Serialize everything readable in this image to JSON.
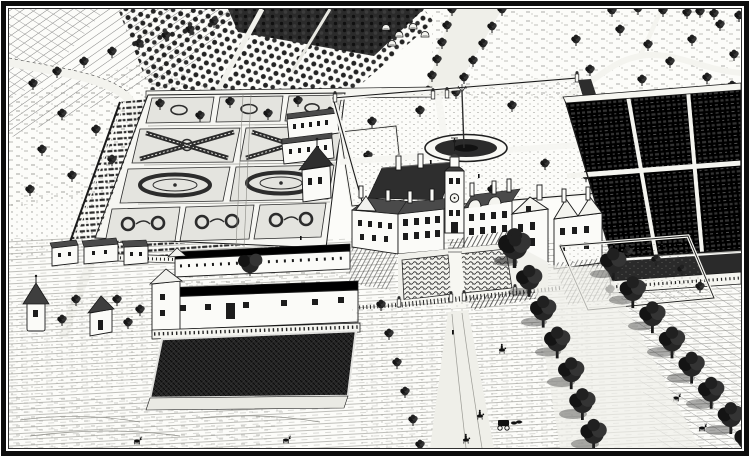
{
  "meta": {
    "title": "Bird's-eye view engraving of an English country estate with formal gardens",
    "medium": "monochrome copperplate engraving",
    "orientation": "oblique aerial view from the south-east"
  },
  "palette": {
    "paper": "#fcfcf9",
    "ink": "#1a1a1a",
    "mid_gray": "#555555",
    "light_gray": "#aaaaaa",
    "pond_water": "#262626"
  },
  "scene": {
    "regions": [
      {
        "name": "frame-border",
        "label": "heavy black rectangular frame"
      },
      {
        "name": "plowed-fields",
        "label": "ploughed strip fields, top left"
      },
      {
        "name": "hedgerow-trees",
        "label": "hedgerow trees along a winding lane"
      },
      {
        "name": "orchard",
        "label": "orchard planted in dense rows"
      },
      {
        "name": "north-avenue",
        "label": "tree-lined avenue receding north"
      },
      {
        "name": "haystacks",
        "label": "haystacks in a meadow"
      },
      {
        "name": "parkland",
        "label": "open parkland with scattered trees and winding path"
      },
      {
        "name": "parterre-garden",
        "label": "great parterre with saltire, oval and scroll beds"
      },
      {
        "name": "espalier-walls",
        "label": "espaliered fruit borders and garden walls"
      },
      {
        "name": "orangery-range",
        "label": "garden buildings along the terrace"
      },
      {
        "name": "garden-pavilion",
        "label": "pavilion with pyramidal roof"
      },
      {
        "name": "fountain-garden",
        "label": "walled lawn garden with oval basin and tall fountain jet"
      },
      {
        "name": "kitchen-garden",
        "label": "walled kitchen garden in bedded rows"
      },
      {
        "name": "manor-house",
        "label": "gabled manor house with clock tower and cupola"
      },
      {
        "name": "forecourt",
        "label": "forecourt parterre with balustrade and gate piers"
      },
      {
        "name": "bowling-green",
        "label": "walled green court with young trees"
      },
      {
        "name": "service-courtyard",
        "label": "barn and stable courtyard with great tree"
      },
      {
        "name": "cottages",
        "label": "row of white estate cottages"
      },
      {
        "name": "dovecote",
        "label": "round dovecote with conical roof"
      },
      {
        "name": "chapel",
        "label": "small chapel with steep roof"
      },
      {
        "name": "pond",
        "label": "dark rectangular stew pond"
      },
      {
        "name": "south-avenue",
        "label": "double avenue of mature trees"
      },
      {
        "name": "travellers",
        "label": "riders and a coach on the approach road"
      },
      {
        "name": "deer",
        "label": "deer grazing in the meadows"
      }
    ]
  }
}
